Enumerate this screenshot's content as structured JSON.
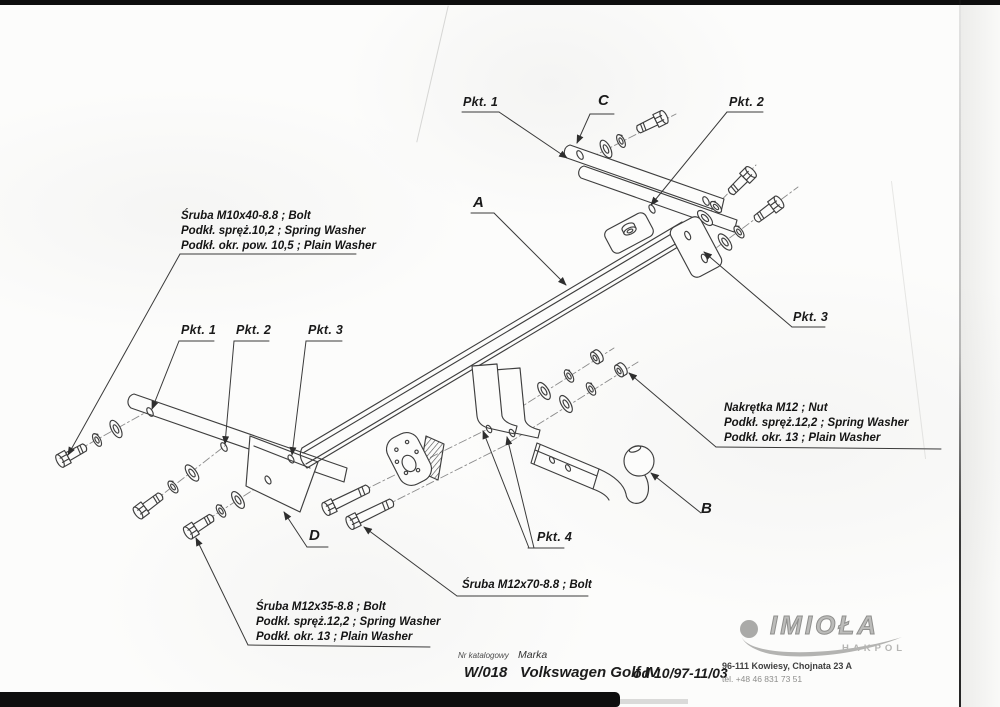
{
  "callouts": {
    "pkt1_top": "Pkt. 1",
    "c_label": "C",
    "pkt2_top": "Pkt. 2",
    "a_label": "A",
    "pkt3_right": "Pkt. 3",
    "pkt1_left": "Pkt. 1",
    "pkt2_left": "Pkt. 2",
    "pkt3_left": "Pkt. 3",
    "d_label": "D",
    "b_label": "B",
    "pkt4": "Pkt. 4"
  },
  "notes": {
    "bolt_m10": {
      "line1": "Śruba M10x40-8.8 ; Bolt",
      "line2": "Podkł. spręż.10,2 ; Spring Washer",
      "line3": "Podkł. okr. pow. 10,5 ; Plain Washer"
    },
    "nut_m12": {
      "line1": "Nakrętka M12 ; Nut",
      "line2": "Podkł. spręż.12,2 ; Spring Washer",
      "line3": "Podkł. okr. 13 ; Plain Washer"
    },
    "bolt_m12x70": {
      "line1": "Śruba M12x70-8.8 ; Bolt"
    },
    "bolt_m12x35": {
      "line1": "Śruba M12x35-8.8 ; Bolt",
      "line2": "Podkł. spręż.12,2 ; Spring Washer",
      "line3": "Podkł. okr. 13 ; Plain Washer"
    }
  },
  "footer": {
    "catalog_label": "Nr katalogowy",
    "catalog_number": "W/018",
    "make_label": "Marka",
    "make_value": "Volkswagen Golf IV",
    "model_years": "od 10/97-11/03"
  },
  "brand": {
    "logo_text": "IMIOŁA",
    "logo_subtext": "HAKPOL",
    "address_line1": "96-111 Kowiesy, Chojnata 23 A",
    "address_line2": "tel. +48 46 831 73 51"
  }
}
